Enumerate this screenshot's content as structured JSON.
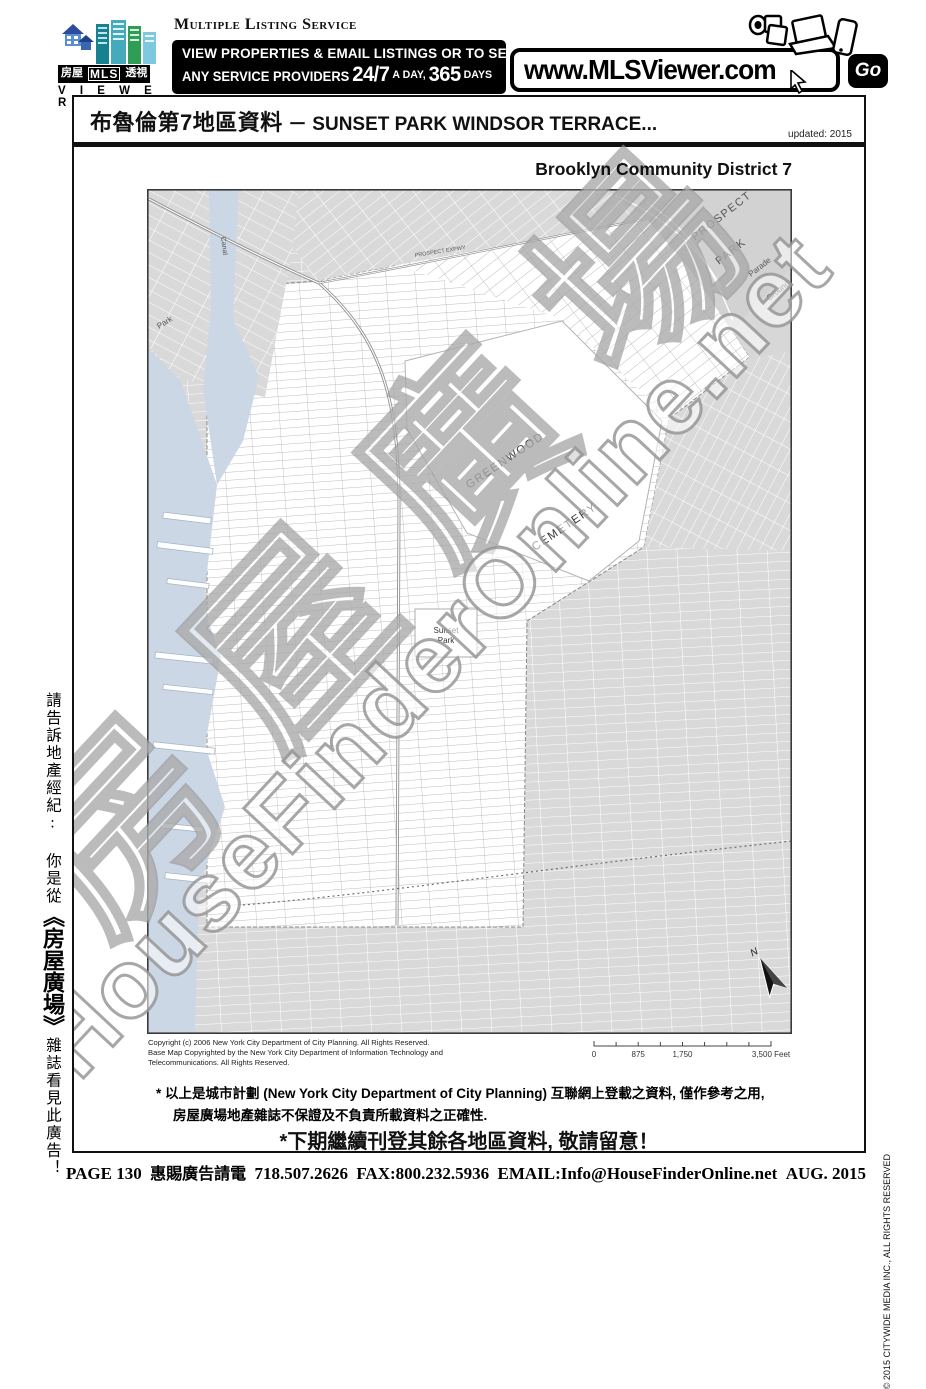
{
  "header": {
    "logo": {
      "boxes": [
        "房屋",
        "MLS",
        "透視"
      ],
      "viewer": "V I E W E R"
    },
    "service_name": "Multiple Listing Service",
    "banner": {
      "line1": "VIEW PROPERTIES & EMAIL LISTINGS OR TO SEARCH",
      "line2_pre": "ANY SERVICE PROVIDERS",
      "big_247": "24/7",
      "a_day": "A DAY,",
      "big_365": "365",
      "days": "DAYS"
    },
    "url": "www.MLSViewer.com",
    "go": "Go"
  },
  "title": {
    "cjk": "布魯倫第7地區資料",
    "en": " － SUNSET PARK WINDSOR TERRACE...",
    "updated": "updated: 2015"
  },
  "map": {
    "title": "Brooklyn Community District 7",
    "labels": {
      "prospect": "PROSPECT",
      "park_word": "PARK",
      "parade": "Parade",
      "ground": "Ground",
      "greenwood": "GREENWOOD",
      "cemetery": "CEMETERY",
      "sunset": "Sunset",
      "sunset2": "Park",
      "canal": "Canal",
      "park_left": "Park",
      "expwy": "PROSPECT EXPWY",
      "north": "N"
    },
    "copyright_line1": "Copyright (c) 2006 New York City Department of City Planning.   All Rights Reserved.",
    "copyright_line2": "Base Map Copyrighted by the New York City Department of Information Technology and",
    "copyright_line3": "Telecommunications.  All Rights Reserved.",
    "scale": {
      "t0": "0",
      "t875": "875",
      "t1750": "1,750",
      "t3500": "3,500 Feet"
    }
  },
  "watermark": {
    "en": "HouseFinderOnline.net",
    "cjk": "房屋廣場"
  },
  "disclaimer": {
    "line1": "* 以上是城市計劃 (New York City Department of City Planning) 互聯網上登載之資料, 僅作參考之用,",
    "line2": "房屋廣場地產雜誌不保證及不負責所載資料之正確性.",
    "notice": "*下期繼續刊登其餘各地區資料, 敬請留意！"
  },
  "sidebar_left": {
    "part1": "請告訴地產經紀: 你是從",
    "brand": "《房屋廣場》",
    "part2": "雜誌看見此廣告！"
  },
  "sidebar_right": "© 2015 CITYWIDE MEDIA INC., ALL RIGHTS RESERVED",
  "footer": {
    "page": "PAGE 130",
    "cjk": "惠賜廣告請電",
    "phone": "718.507.2626",
    "fax": "FAX:800.232.5936",
    "email": "EMAIL:Info@HouseFinderOnline.net",
    "date": "AUG. 2015"
  }
}
